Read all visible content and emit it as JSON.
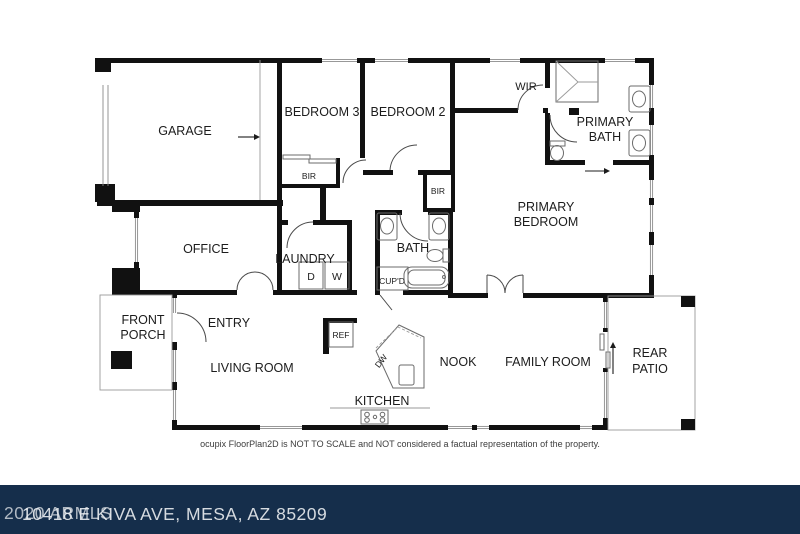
{
  "rooms": {
    "garage": "GARAGE",
    "bedroom3": "BEDROOM 3",
    "bedroom2": "BEDROOM 2",
    "wir": "WIR",
    "primary_bath_1": "PRIMARY",
    "primary_bath_2": "BATH",
    "primary_bedroom_1": "PRIMARY",
    "primary_bedroom_2": "BEDROOM",
    "office": "OFFICE",
    "laundry": "LAUNDRY",
    "bath": "BATH",
    "front_porch_1": "FRONT",
    "front_porch_2": "PORCH",
    "entry": "ENTRY",
    "living_room": "LIVING ROOM",
    "kitchen": "KITCHEN",
    "nook": "NOOK",
    "family_room": "FAMILY ROOM",
    "rear_patio_1": "REAR",
    "rear_patio_2": "PATIO"
  },
  "fixtures": {
    "bir3": "BIR",
    "bir2": "BIR",
    "dryer": "D",
    "washer": "W",
    "cupboard": "CUP'D",
    "fridge": "REF",
    "dishwasher": "DW"
  },
  "disclaimer": "ocupix FloorPlan2D is NOT TO SCALE and NOT considered a factual representation of the property.",
  "footer": {
    "address": "10418 E KIVA AVE, MESA, AZ 85209",
    "watermark": "2020 ARMLS"
  },
  "colors": {
    "wall": "#111111",
    "footer_bar": "#152e4b",
    "footer_text": "#d6dbe0"
  }
}
